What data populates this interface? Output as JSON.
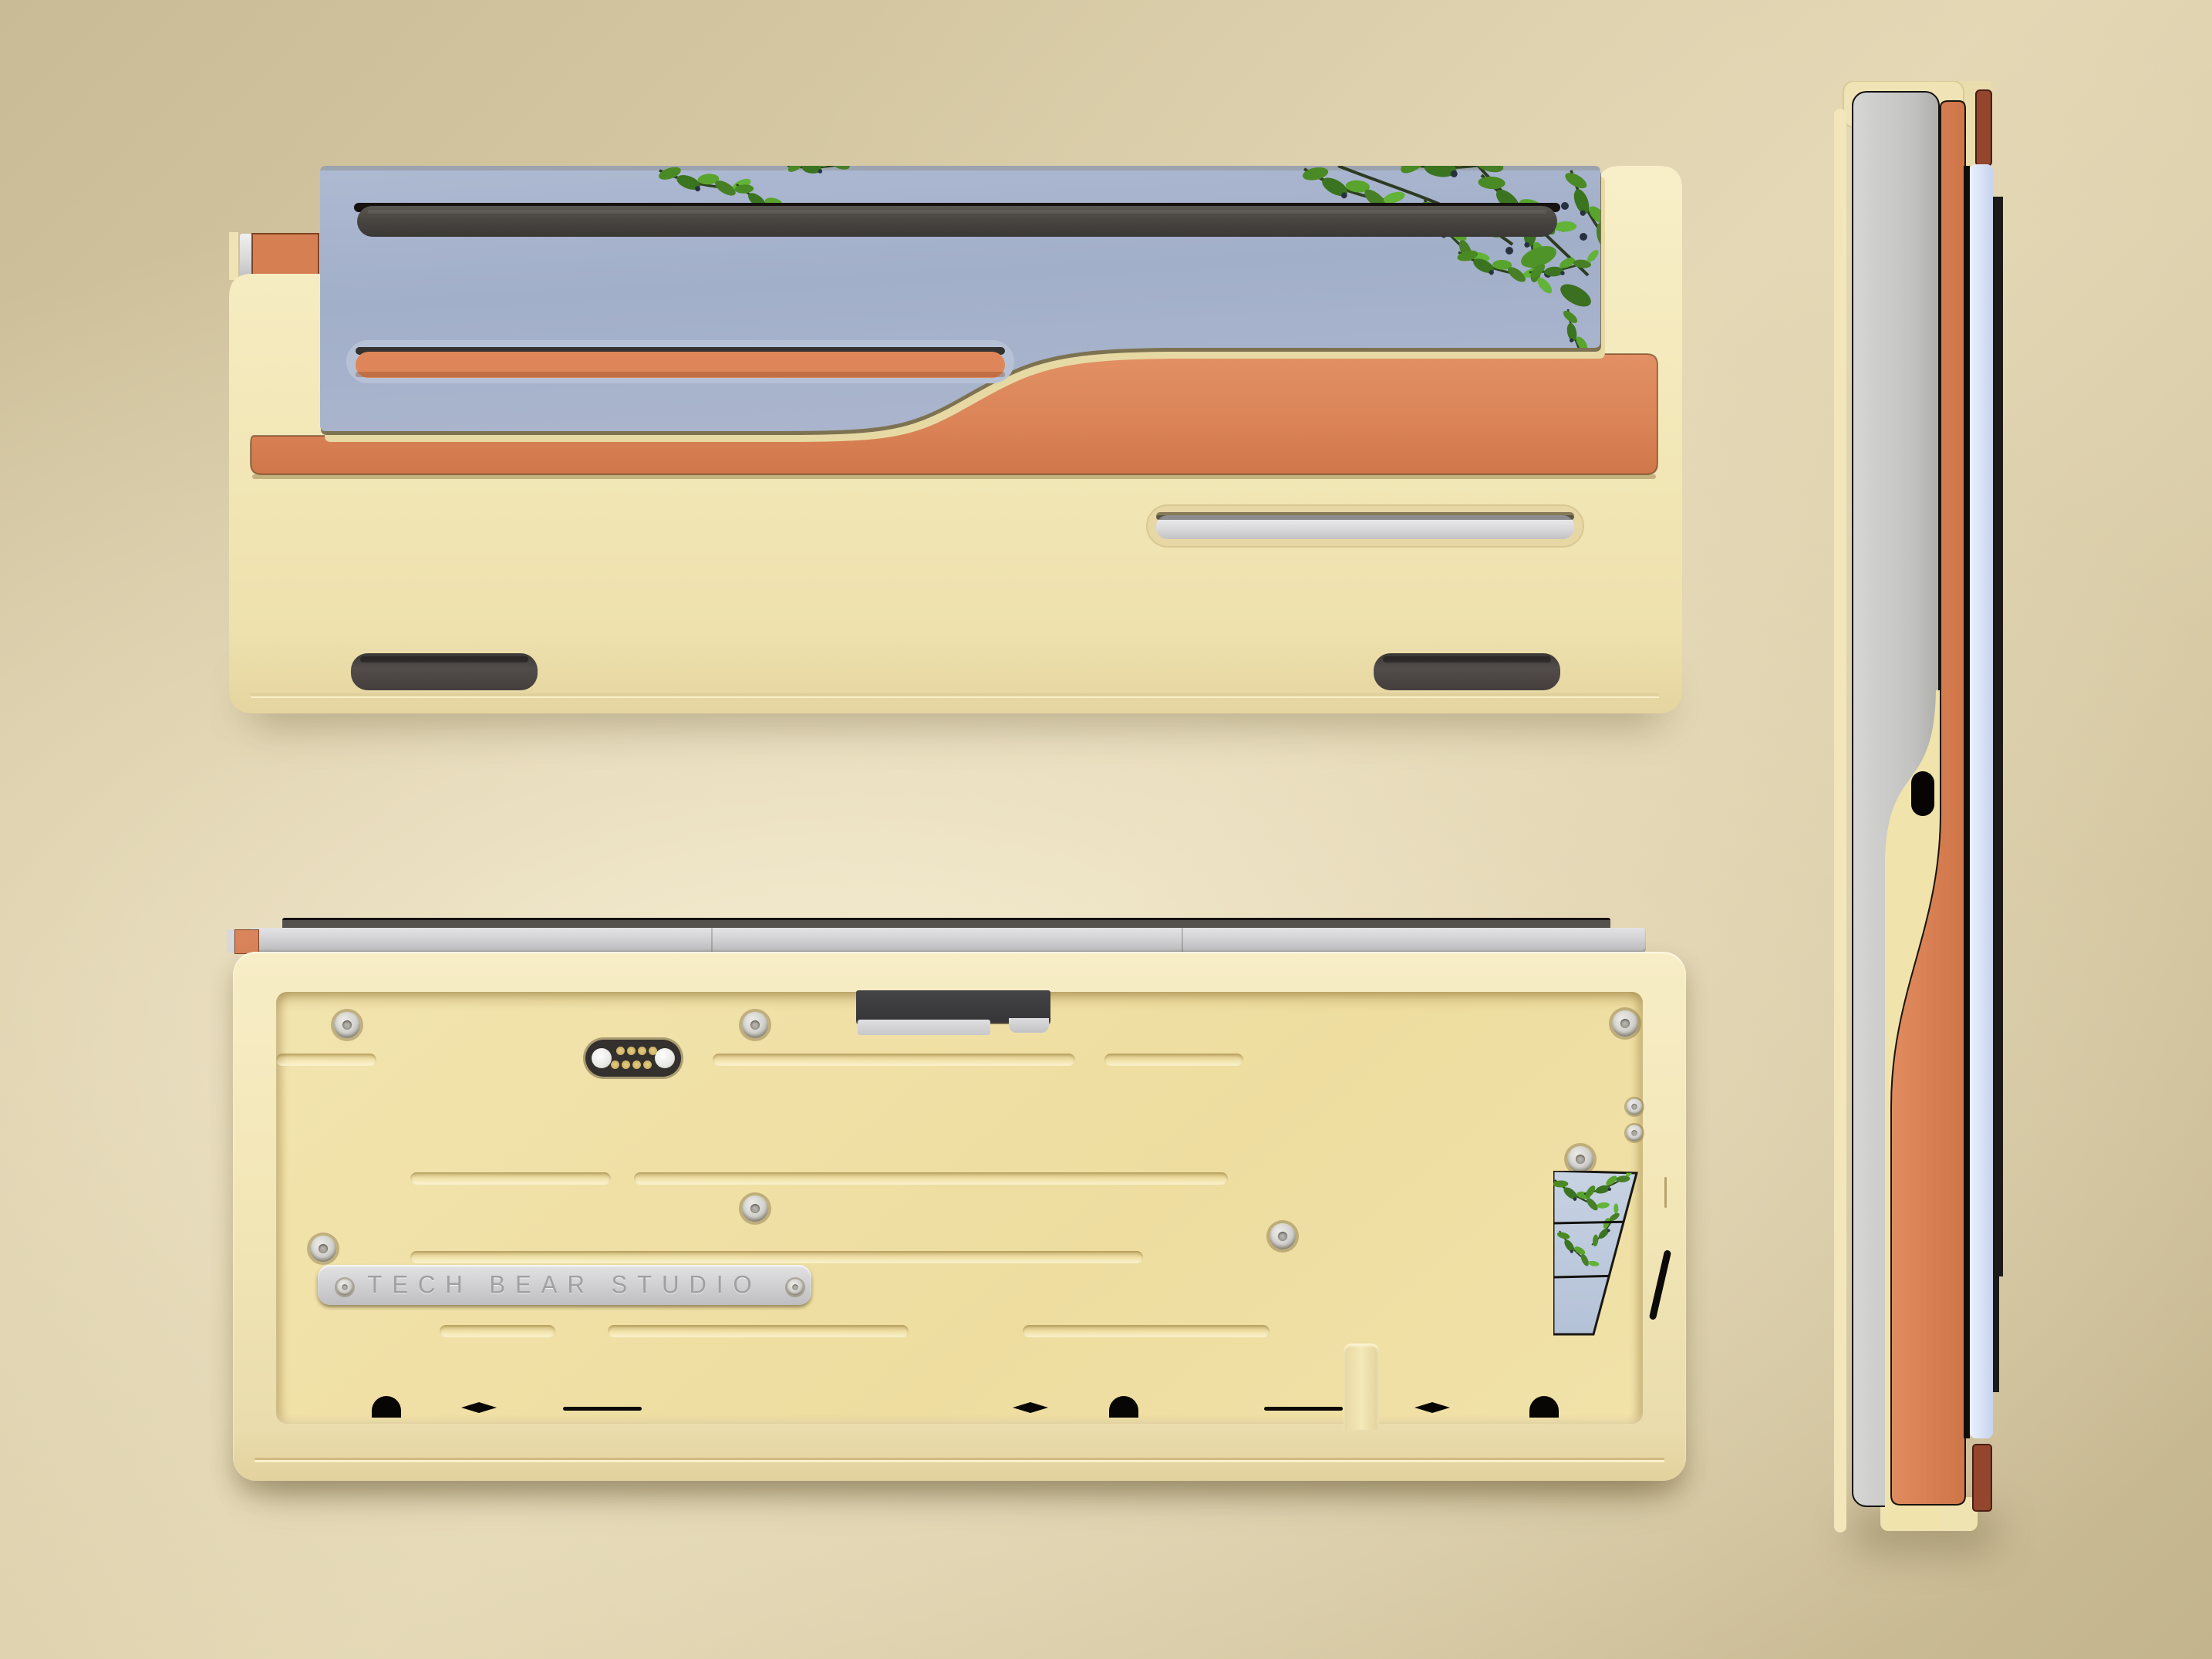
{
  "branding": {
    "engraving": "TECH BEAR STUDIO"
  },
  "palette": {
    "bg": "#d3c5a0",
    "bg-light": "#eee3c4",
    "cream": "#f4eabf",
    "cream-deep": "#e8daa6",
    "cream-floor": "#f0e2a8",
    "orange": "#dd8a5f",
    "orange-deep": "#c9713f",
    "mirror-blue": "#a9b5cf",
    "mirror-blue-deep": "#9dabc6",
    "leaf-green": "#4a8a24",
    "slot-dark": "#45423f",
    "foot-dark": "#4b4645",
    "silver": "#d7d7d9",
    "steel-edge": "#dfe9fb",
    "maroon": "#93452d",
    "gold-pin": "#d5b95f",
    "engraving-gray": "#9c9c9e"
  }
}
